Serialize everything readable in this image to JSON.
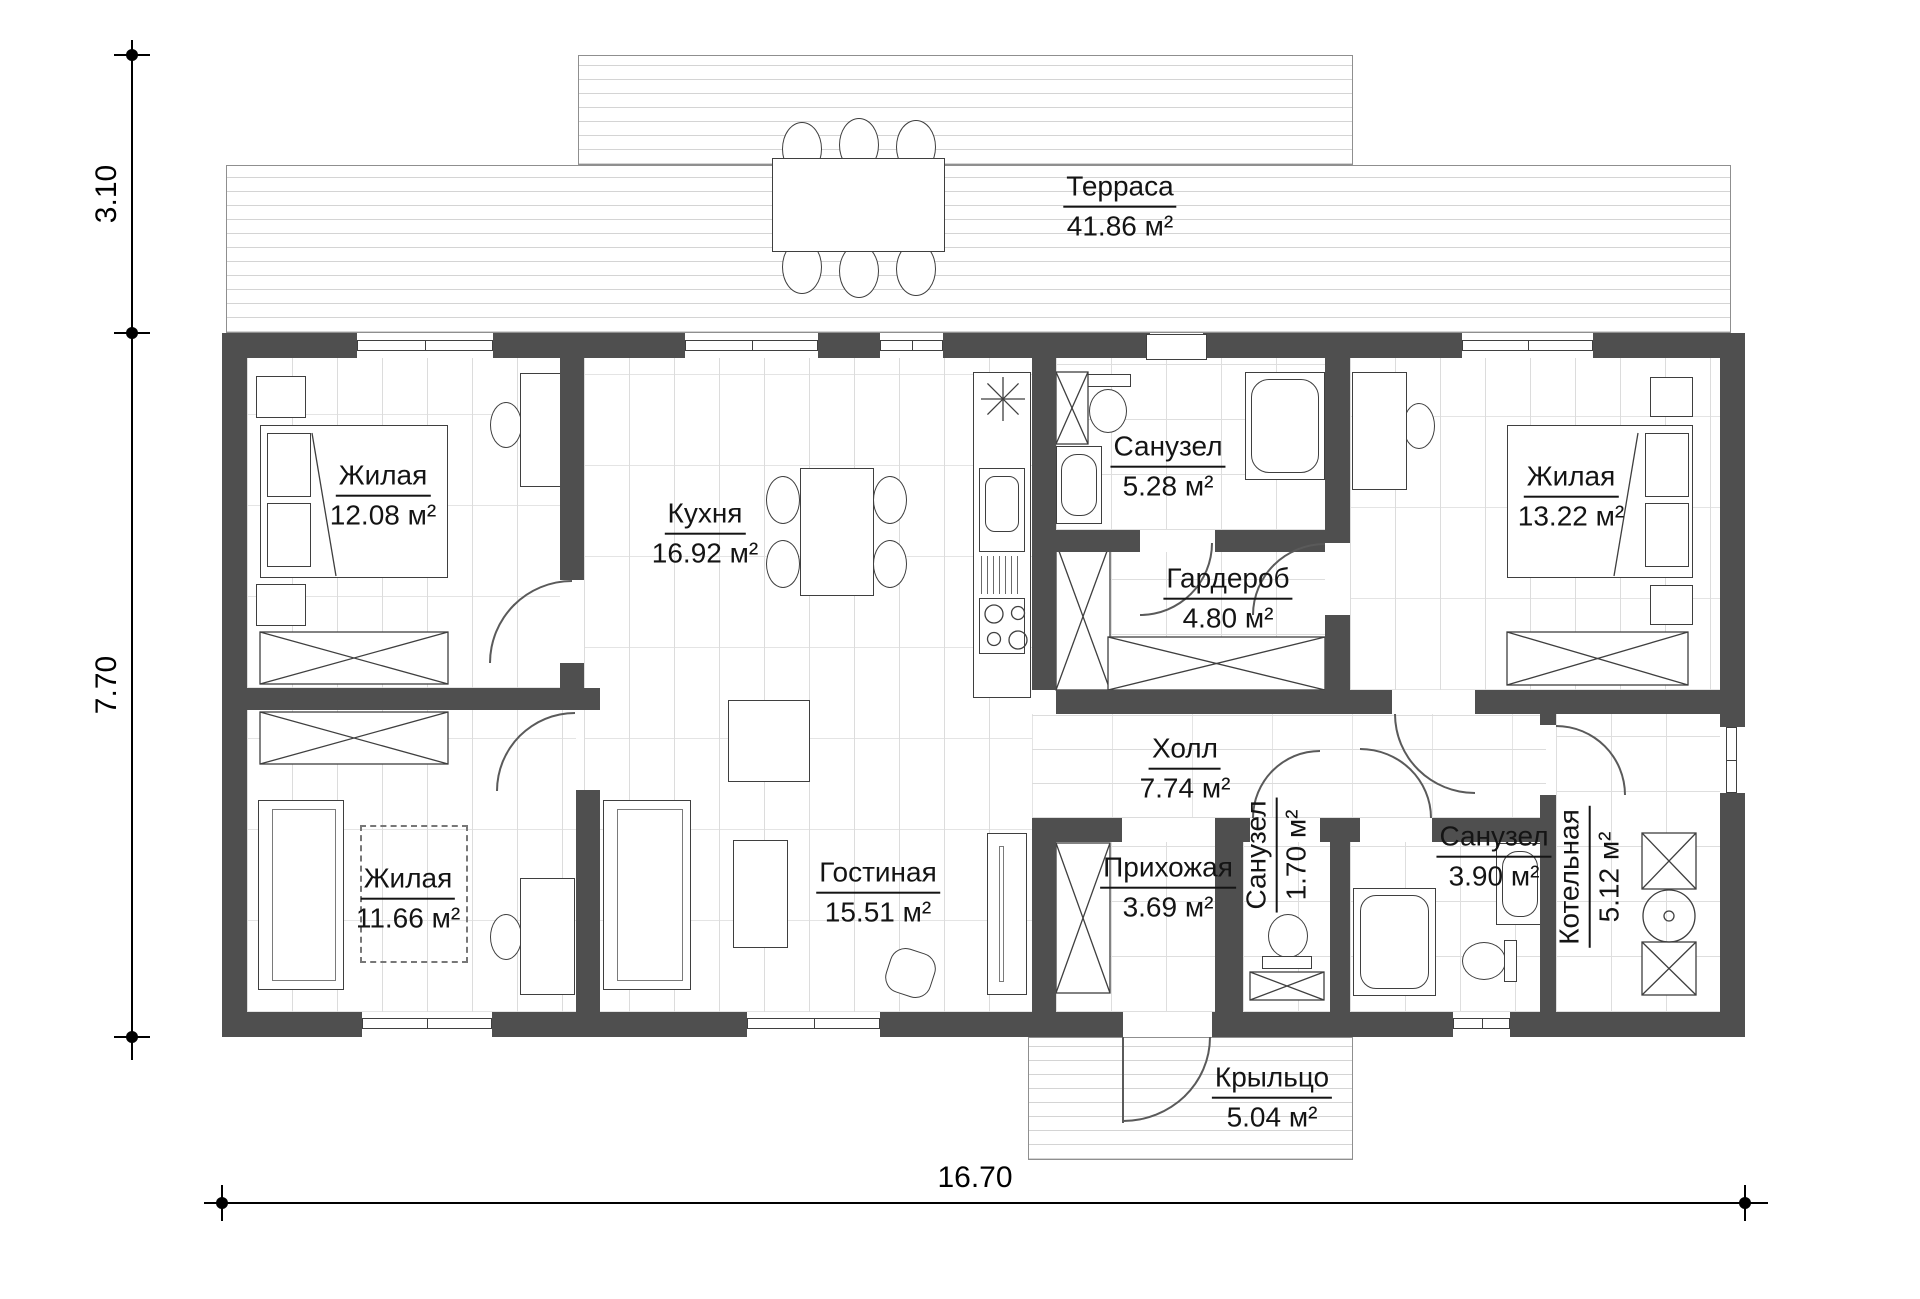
{
  "rooms": [
    {
      "id": "terrace",
      "name": "Терраса",
      "area": "41.86 м²"
    },
    {
      "id": "bedroom-1",
      "name": "Жилая",
      "area": "12.08 м²"
    },
    {
      "id": "kitchen",
      "name": "Кухня",
      "area": "16.92 м²"
    },
    {
      "id": "bathroom-1",
      "name": "Санузел",
      "area": "5.28 м²"
    },
    {
      "id": "wardrobe",
      "name": "Гардероб",
      "area": "4.80 м²"
    },
    {
      "id": "bedroom-2",
      "name": "Жилая",
      "area": "13.22 м²"
    },
    {
      "id": "hall",
      "name": "Холл",
      "area": "7.74 м²"
    },
    {
      "id": "bedroom-3",
      "name": "Жилая",
      "area": "11.66 м²"
    },
    {
      "id": "living",
      "name": "Гостиная",
      "area": "15.51 м²"
    },
    {
      "id": "entry",
      "name": "Прихожая",
      "area": "3.69 м²"
    },
    {
      "id": "wc",
      "name": "Санузел",
      "area": "1.70 м²"
    },
    {
      "id": "bathroom-2",
      "name": "Санузел",
      "area": "3.90 м²"
    },
    {
      "id": "boiler",
      "name": "Котельная",
      "area": "5.12 м²"
    },
    {
      "id": "porch",
      "name": "Крыльцо",
      "area": "5.04 м²"
    }
  ],
  "dimensions": {
    "terrace_depth": "3.10",
    "house_depth": "7.70",
    "house_width": "16.70"
  },
  "colors": {
    "wall": "#4f4f4f",
    "line": "#141414",
    "floor_line": "#dcdcdc"
  }
}
